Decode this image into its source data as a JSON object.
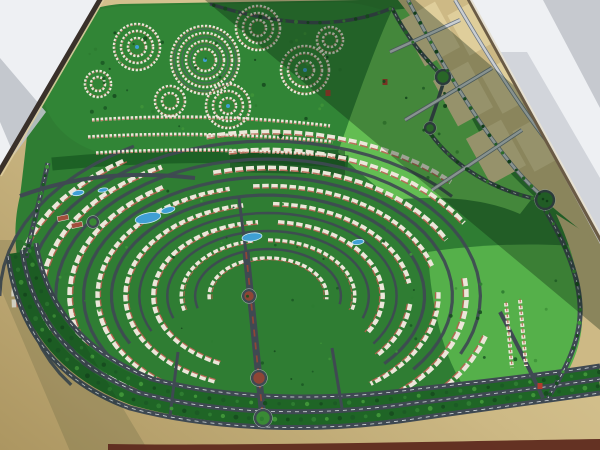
{
  "scene": {
    "description": "photograph of an architectural scale model of a master-planned residential community viewed obliquely, with window shadow bands and white showroom floor at two corners",
    "canvas": {
      "width": 600,
      "height": 450
    },
    "colors": {
      "sand_light": "#e3d3a3",
      "sand_mid": "#cdb985",
      "sand_dark": "#ac9661",
      "green_base": "#2f7d33",
      "green_lawn": "#55b04a",
      "green_lawn2": "#63bd52",
      "green_belt": "#1d6125",
      "green_median": "#1f6526",
      "road_dark": "#3f4952",
      "road_dash": "#e8ebee",
      "parcel_fill": "#dfce9b",
      "parcel_road": "#c9ced3",
      "parcel_casing": "#6f7881",
      "building_white": "#ece7da",
      "roof_red": "#b55f4b",
      "pool_blue": "#3f9fd4",
      "pool_rim": "#cfe9f6",
      "court_red": "#a14f3c",
      "median_red": "#8e4636",
      "landmark_red": "#b23c2e",
      "floor_white": "#eef0f3",
      "floor_shadow1": "#c6c9cf",
      "floor_shadow2": "#cdd0d6",
      "floor_shadow3": "#bfc3ca",
      "edge_dark": "#39302a",
      "edge_light": "#decda0",
      "edge_right_dark": "#6a5b45",
      "edge_right_light": "#e6e1d3",
      "table_maroon": "#5e2a1d",
      "shadow_band": "#0a1f0e",
      "tree_palette": [
        "#1c5a25",
        "#2e7c31",
        "#3f9438",
        "#174d1f"
      ]
    },
    "floor": {
      "top_left_triangle": [
        [
          0,
          0
        ],
        [
          100,
          0
        ],
        [
          0,
          172
        ]
      ],
      "top_left_band": [
        [
          0,
          58
        ],
        [
          0,
          122
        ],
        [
          14,
          155
        ],
        [
          46,
          112
        ]
      ],
      "top_right_triangle": [
        [
          468,
          0
        ],
        [
          600,
          0
        ],
        [
          600,
          238
        ]
      ],
      "top_right_corner_band": [
        [
          543,
          0
        ],
        [
          600,
          0
        ],
        [
          600,
          108
        ]
      ],
      "top_right_edge_band": [
        [
          497,
          52
        ],
        [
          600,
          244
        ],
        [
          600,
          178
        ],
        [
          527,
          52
        ]
      ],
      "left_edge": [
        [
          101,
          -2
        ],
        [
          -2,
          174
        ]
      ],
      "left_edge_hi": [
        [
          104,
          -1
        ],
        [
          1,
          176
        ]
      ],
      "right_edge": [
        [
          468,
          -2
        ],
        [
          602,
          242
        ]
      ],
      "right_edge_hi": [
        [
          470,
          -2
        ],
        [
          604,
          241
        ]
      ],
      "bottom_strip": "M108,450 L600,450 L600,439 C460,441 260,446 108,444 Z"
    },
    "model": {
      "green_base": "M36,70 C48,22 80,8 120,4 L360,0 L470,0 L600,238 L600,392 C560,398 520,404 470,408 C380,422 280,430 190,414 C110,398 50,350 26,290 C12,255 14,220 20,196 C26,150 30,100 36,70 Z",
      "district_blob": "M40,66 C52,24 84,9 122,6 L340,2 C375,4 400,14 412,34 C424,56 420,86 402,112 C380,142 340,158 300,160 L128,158 C92,156 60,138 48,112 C40,96 38,82 40,66 Z",
      "lawn_top_right": "M338,152 C360,90 378,40 392,10 L452,4 C446,30 448,60 462,96 C476,134 500,166 534,196 L520,214 C480,196 430,196 392,200 C370,180 350,166 338,152 Z",
      "lawn_bottom_right": "M428,252 C480,244 540,242 600,248 L600,382 C560,388 520,394 474,400 C448,370 432,320 428,252 Z",
      "greenbelt": "M52,164 Q200,150 348,162",
      "greenbelt_shadow": [
        [
          230,
          150
        ],
        [
          345,
          150
        ],
        [
          345,
          175
        ],
        [
          230,
          172
        ]
      ],
      "sand_parcels_region": "M398,0 L468,0 L600,238 L600,246 L556,210 C510,172 452,90 412,18 Z",
      "sand_right_strip": "M556,214 C572,248 580,280 582,310 C584,345 570,372 552,396 L600,390 L600,242 Z",
      "parcel_blocks": [
        {
          "x": 430,
          "y": 34,
          "w": 40,
          "h": 52,
          "rot": -28.8
        },
        {
          "x": 463,
          "y": 94,
          "w": 40,
          "h": 52,
          "rot": -28.8
        },
        {
          "x": 496,
          "y": 152,
          "w": 40,
          "h": 52,
          "rot": -28.8
        },
        {
          "x": 476,
          "y": 26,
          "w": 40,
          "h": 46,
          "rot": -28.8
        },
        {
          "x": 509,
          "y": 84,
          "w": 40,
          "h": 46,
          "rot": -28.8
        },
        {
          "x": 541,
          "y": 142,
          "w": 40,
          "h": 46,
          "rot": -28.8
        }
      ]
    },
    "community_arcs": {
      "center": [
        268,
        296
      ],
      "kx": 1.55,
      "road_rings": [
        {
          "ry": 47,
          "segs": [
            [
              -195,
              10
            ]
          ]
        },
        {
          "ry": 65,
          "segs": [
            [
              -200,
              20
            ]
          ]
        },
        {
          "ry": 83,
          "segs": [
            [
              -205,
              35
            ]
          ]
        },
        {
          "ry": 101,
          "segs": [
            [
              -208,
              45
            ]
          ]
        },
        {
          "ry": 119,
          "segs": [
            [
              -212,
              40
            ]
          ]
        },
        {
          "ry": 137,
          "segs": [
            [
              -215,
              25
            ]
          ]
        },
        {
          "ry": 155,
          "segs": [
            [
              -215,
              -40
            ]
          ]
        },
        {
          "ry": 173,
          "segs": [
            [
              -180,
              -120
            ]
          ]
        }
      ],
      "building_rows": [
        {
          "ry": 38,
          "segs": [
            [
              -185,
              5
            ]
          ]
        },
        {
          "ry": 56,
          "segs": [
            [
              -195,
              -100
            ],
            [
              -90,
              15
            ]
          ]
        },
        {
          "ry": 74,
          "segs": [
            [
              -200,
              -95
            ],
            [
              -85,
              30
            ],
            [
              115,
              168
            ]
          ]
        },
        {
          "ry": 92,
          "segs": [
            [
              -205,
              -100
            ],
            [
              -88,
              -5
            ],
            [
              5,
              42
            ],
            [
              112,
              165
            ]
          ]
        },
        {
          "ry": 110,
          "segs": [
            [
              -208,
              -103
            ],
            [
              -95,
              -12
            ],
            [
              -2,
              55
            ],
            [
              122,
              170
            ]
          ]
        },
        {
          "ry": 128,
          "segs": [
            [
              -212,
              -118
            ],
            [
              -106,
              -22
            ],
            [
              -8,
              58
            ],
            [
              132,
              174
            ]
          ]
        },
        {
          "ry": 146,
          "segs": [
            [
              -198,
              -114
            ],
            [
              -100,
              -30
            ],
            [
              16,
              56
            ]
          ]
        },
        {
          "ry": 164,
          "segs": [
            [
              -184,
              -120
            ],
            [
              -104,
              -44
            ]
          ]
        }
      ]
    },
    "boulevard": {
      "ribbons": [
        "M15,253 C25,324 64,374 135,400 C222,424 328,424 418,410 C496,400 558,392 600,386",
        "M29,247 C39,313 77,359 146,386 C230,408 328,408 416,396 C492,387 556,379 600,372"
      ],
      "roads": [
        "M8,256 C18,330 58,382 130,408 C220,432 330,432 420,418 C500,407 560,399 600,393",
        "M22,250 C32,318 70,366 140,393 C225,416 325,416 415,403 C492,394 556,386 600,379",
        "M36,243 C46,308 84,352 152,379 C235,401 330,401 418,389 C492,381 556,373 600,366"
      ]
    },
    "avenue": {
      "main": "M246,252 C251,300 255,340 263,418",
      "north_ext": "M246,252 C243,230 241,215 239,198"
    },
    "roads": [
      {
        "d": "M48,163 C40,200 32,228 26,258",
        "w": 5,
        "dash": true,
        "name": "west-boundary-road"
      },
      {
        "d": "M20,196 C70,178 120,170 195,178",
        "w": 4,
        "dash": false,
        "name": "west-collector-road"
      },
      {
        "d": "M392,8 C408,40 425,58 443,77",
        "w": 4,
        "dash": true,
        "name": "northeast-road"
      },
      {
        "d": "M443,84 C438,100 434,112 430,123",
        "w": 3.5,
        "dash": false,
        "name": "connector-road"
      },
      {
        "d": "M430,133 C455,168 495,190 536,199",
        "w": 4,
        "dash": true,
        "name": "east-collector-road"
      },
      {
        "d": "M545,209 C560,235 578,268 580,305 C582,340 565,370 548,398",
        "w": 5,
        "dash": true,
        "name": "east-edge-road"
      },
      {
        "d": "M500,312 C515,340 530,370 543,398",
        "w": 4,
        "dash": false,
        "name": "southeast-diagonal-road"
      },
      {
        "d": "M210,4 C280,26 340,30 392,8",
        "w": 3.5,
        "dash": false,
        "name": "north-rim-road"
      },
      {
        "d": "M178,352 L170,416",
        "w": 3,
        "dash": false,
        "name": "south-connector-a"
      },
      {
        "d": "M332,348 L342,408",
        "w": 3,
        "dash": false,
        "name": "south-connector-b"
      }
    ],
    "parcel_roads": [
      "M408,0 C450,80 500,160 542,196",
      "M455,0 C490,60 525,115 558,155",
      "M390,52 L460,20",
      "M405,120 L492,68",
      "M432,190 L522,130"
    ],
    "villa_clusters": [
      {
        "x": 137,
        "y": 47,
        "rings": [
          9,
          16,
          23
        ],
        "pool": true
      },
      {
        "x": 205,
        "y": 60,
        "rings": [
          11,
          19,
          27,
          34
        ],
        "pool": true,
        "roads": [
          15,
          23,
          31
        ]
      },
      {
        "x": 258,
        "y": 28,
        "rings": [
          8,
          15,
          22
        ],
        "pool": false
      },
      {
        "x": 305,
        "y": 70,
        "rings": [
          9,
          17,
          24
        ],
        "pool": true
      },
      {
        "x": 170,
        "y": 101,
        "rings": [
          8,
          15
        ],
        "pool": false
      },
      {
        "x": 228,
        "y": 106,
        "rings": [
          8,
          15,
          22
        ],
        "pool": true
      },
      {
        "x": 98,
        "y": 84,
        "rings": [
          7,
          13
        ],
        "pool": false
      },
      {
        "x": 330,
        "y": 40,
        "rings": [
          7,
          13
        ],
        "pool": false
      }
    ],
    "district_rows": [
      "M92,120 Q210,112 330,126",
      "M88,137 Q210,130 333,142",
      "M96,153 Q215,146 336,156"
    ],
    "house_columns_br": [
      "M506,303 L512,368",
      "M520,300 L526,366"
    ],
    "pools": [
      {
        "x": 148,
        "y": 218,
        "rx": 13,
        "ry": 5,
        "rot": -12
      },
      {
        "x": 252,
        "y": 237,
        "rx": 10,
        "ry": 4,
        "rot": -8
      },
      {
        "x": 168,
        "y": 210,
        "rx": 7,
        "ry": 3,
        "rot": -14
      },
      {
        "x": 78,
        "y": 193,
        "rx": 6,
        "ry": 2.5,
        "rot": -10
      },
      {
        "x": 103,
        "y": 190,
        "rx": 5,
        "ry": 2,
        "rot": -10
      },
      {
        "x": 358,
        "y": 242,
        "rx": 6,
        "ry": 2.5,
        "rot": -8
      }
    ],
    "courts": [
      {
        "x": 63,
        "y": 218,
        "w": 11,
        "h": 5,
        "rot": -12
      },
      {
        "x": 77,
        "y": 225,
        "w": 11,
        "h": 5,
        "rot": -12
      }
    ],
    "roundabouts": [
      {
        "x": 443,
        "y": 77,
        "r": 7,
        "inner": "green"
      },
      {
        "x": 430,
        "y": 128,
        "r": 5,
        "inner": "green"
      },
      {
        "x": 545,
        "y": 200,
        "r": 9,
        "inner": "trees"
      },
      {
        "x": 249,
        "y": 296,
        "r": 6,
        "inner": "red"
      },
      {
        "x": 259,
        "y": 378,
        "r": 7,
        "inner": "red"
      },
      {
        "x": 93,
        "y": 222,
        "r": 5,
        "inner": "green"
      },
      {
        "x": 263,
        "y": 418,
        "r": 8,
        "inner": "green"
      }
    ],
    "landmarks_red": [
      [
        328,
        93
      ],
      [
        385,
        82
      ],
      [
        540,
        386
      ]
    ],
    "shadow_bands": [
      {
        "pts": [
          [
            205,
            0
          ],
          [
            415,
            0
          ],
          [
            600,
            160
          ],
          [
            600,
            330
          ]
        ],
        "opacity": 0.34
      },
      {
        "pts": [
          [
            -20,
            240
          ],
          [
            22,
            240
          ],
          [
            160,
            470
          ],
          [
            78,
            470
          ]
        ],
        "opacity": 0.12
      }
    ],
    "tree_lines": [
      {
        "path": "M15,253 C25,324 64,374 135,400 C222,424 328,424 418,410 C496,400 558,392 600,386",
        "spacing": 13,
        "r": 1.9
      },
      {
        "path": "M29,247 C39,313 77,359 146,386 C230,408 328,408 416,396 C492,387 556,379 600,372",
        "spacing": 14,
        "r": 1.7
      },
      {
        "path": "M48,163 C40,200 32,228 26,258",
        "spacing": 9,
        "r": 1.5
      },
      {
        "path": "M392,8 C408,40 425,58 443,77",
        "spacing": 12,
        "r": 1.5
      },
      {
        "path": "M430,133 C455,168 495,190 536,199",
        "spacing": 12,
        "r": 1.5
      },
      {
        "path": "M545,209 C560,235 578,268 580,305 C582,340 565,370 548,398",
        "spacing": 13,
        "r": 1.6
      },
      {
        "path": "M408,0 C450,80 500,160 542,196",
        "spacing": 11,
        "r": 1.4
      },
      {
        "path": "M210,4 C280,26 340,30 392,8",
        "spacing": 12,
        "r": 1.5
      }
    ],
    "tree_scatters": [
      {
        "cx": 220,
        "cy": 82,
        "rx": 160,
        "ry": 66,
        "n": 46,
        "seed": 11,
        "rmin": 1.0,
        "rmax": 2.2
      },
      {
        "cx": 250,
        "cy": 285,
        "rx": 195,
        "ry": 105,
        "n": 40,
        "seed": 23,
        "rmin": 0.8,
        "rmax": 1.6
      },
      {
        "cx": 505,
        "cy": 315,
        "rx": 70,
        "ry": 52,
        "n": 12,
        "seed": 37,
        "rmin": 1.2,
        "rmax": 2.0
      },
      {
        "cx": 415,
        "cy": 115,
        "rx": 55,
        "ry": 70,
        "n": 10,
        "seed": 51,
        "rmin": 1.2,
        "rmax": 2.0
      }
    ]
  }
}
